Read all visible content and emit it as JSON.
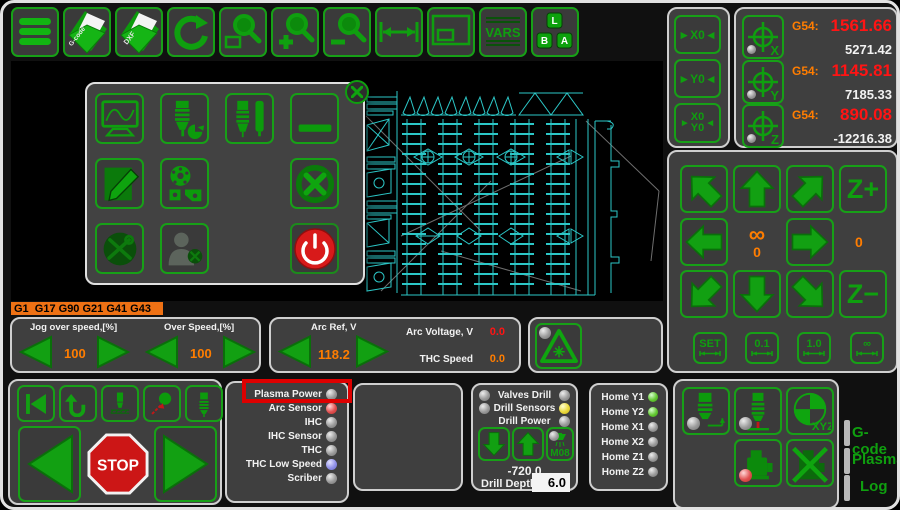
{
  "toolbar": {
    "gcode_file_label": "G-code",
    "dxf_file_label": "DXF",
    "vars_label": "VARS",
    "key_l": "L",
    "key_b": "B",
    "key_a": "A"
  },
  "zero_buttons": {
    "x0": "►X0◄",
    "y0": "►Y0◄",
    "xy_line1": "X0",
    "xy_line2": "Y0",
    "left_arrow": "►",
    "right_arrow": "◄"
  },
  "axes": [
    {
      "axis": "X",
      "wcs": "G54:",
      "program": "1561.66",
      "machine": "5271.42"
    },
    {
      "axis": "Y",
      "wcs": "G54:",
      "program": "1145.81",
      "machine": "7185.33"
    },
    {
      "axis": "Z",
      "wcs": "G54:",
      "program": "890.08",
      "machine": "-12216.38"
    }
  ],
  "jog": {
    "z_plus": "Z+",
    "z_minus": "Z−",
    "center_top": "∞",
    "center_bottom": "0",
    "right_value": "0",
    "steps": [
      "SET",
      "0.1",
      "1.0",
      "∞"
    ]
  },
  "gcode_state": "G1  G17 G90 G21 G41 G43",
  "speed": {
    "jog_label": "Jog over speed,[%]",
    "jog_value": "100",
    "over_label": "Over Speed,[%]",
    "over_value": "100"
  },
  "arc": {
    "ref_label": "Arc Ref, V",
    "ref_value": "118.2",
    "voltage_label": "Arc Voltage, V",
    "voltage_value": "0.0",
    "thc_label": "THC Speed",
    "thc_value": "0.0"
  },
  "indicators": [
    {
      "label": "Plasma Power",
      "state": "gray"
    },
    {
      "label": "Arc Sensor",
      "state": "red"
    },
    {
      "label": "IHC",
      "state": "gray"
    },
    {
      "label": "IHC Sensor",
      "state": "gray"
    },
    {
      "label": "THC",
      "state": "gray"
    },
    {
      "label": "THC Low Speed",
      "state": "blue"
    },
    {
      "label": "Scriber",
      "state": "gray"
    }
  ],
  "drill": {
    "valves_label": "Valves Drill",
    "valves_left": "gray",
    "valves_right": "gray",
    "sensors_label": "Drill Sensors",
    "sensors_left": "gray",
    "sensors_right": "yellow",
    "power_label": "Drill Power",
    "power_right": "gray",
    "m08_label": "M08",
    "m08_led": "gray",
    "position": "-720.0",
    "depth_label": "Drill Depth",
    "depth_value": "6.0"
  },
  "home": [
    {
      "label": "Home Y1",
      "state": "green"
    },
    {
      "label": "Home Y2",
      "state": "green"
    },
    {
      "label": "Home X1",
      "state": "gray"
    },
    {
      "label": "Home X2",
      "state": "gray"
    },
    {
      "label": "Home Z1",
      "state": "gray"
    },
    {
      "label": "Home Z2",
      "state": "gray"
    }
  ],
  "stop_label": "STOP",
  "xyz_label": "XYZ",
  "tabs": [
    "G-code",
    "Plasma",
    "Log"
  ],
  "colors": {
    "accent_green": "#0f9f0f",
    "value_orange": "#ff7d00",
    "value_red": "#ff1414",
    "highlight_red": "#dd0000",
    "cad_cyan": "#2cc7c7",
    "state_bar_orange": "#ee7114"
  }
}
